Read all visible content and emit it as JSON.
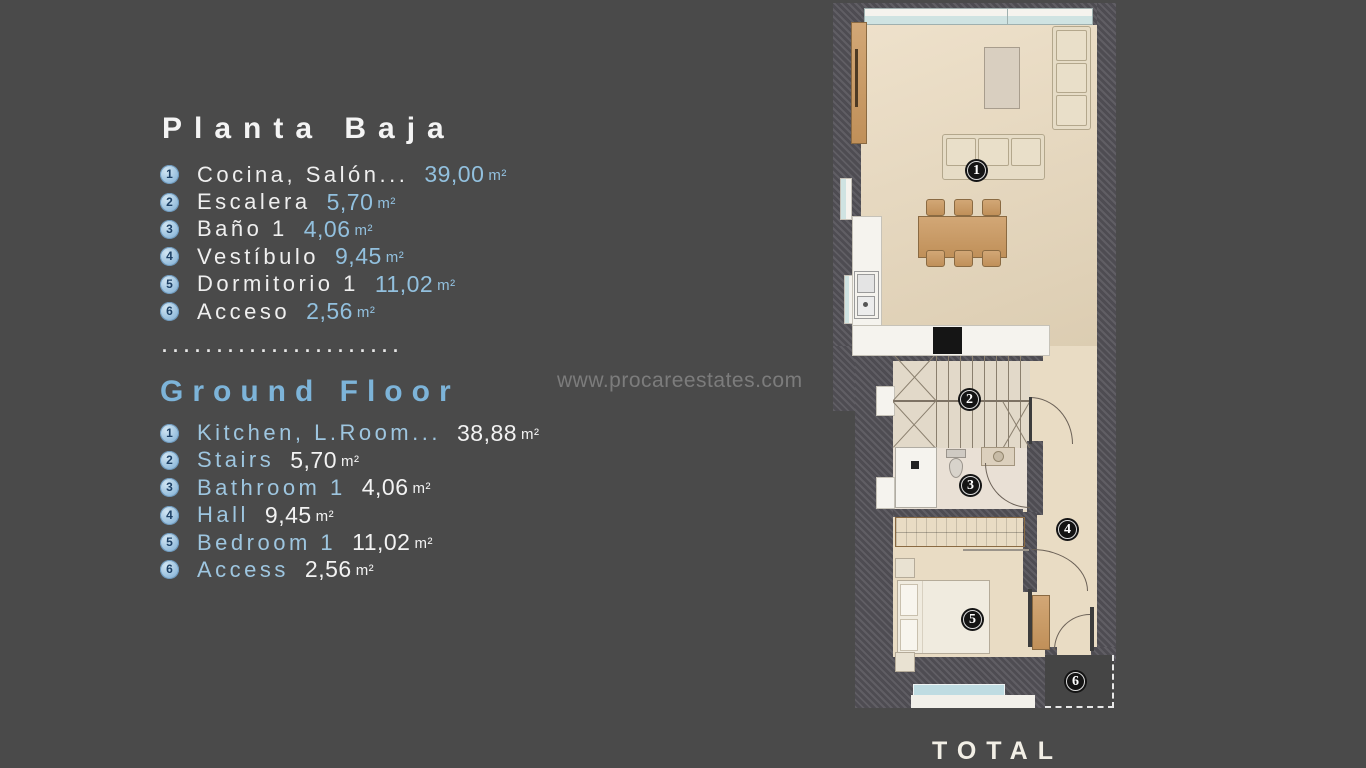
{
  "planta_baja": {
    "title": "Planta Baja",
    "items": [
      {
        "num": "1",
        "label": "Cocina, Salón...",
        "value": "39,00",
        "unit": "m²"
      },
      {
        "num": "2",
        "label": "Escalera",
        "value": "5,70",
        "unit": "m²"
      },
      {
        "num": "3",
        "label": "Baño 1",
        "value": "4,06",
        "unit": "m²"
      },
      {
        "num": "4",
        "label": "Vestíbulo",
        "value": "9,45",
        "unit": "m²"
      },
      {
        "num": "5",
        "label": "Dormitorio 1",
        "value": "11,02",
        "unit": "m²"
      },
      {
        "num": "6",
        "label": "Acceso",
        "value": "2,56",
        "unit": "m²"
      }
    ]
  },
  "separator": {
    "dots": "......................"
  },
  "ground_floor": {
    "title": "Ground Floor",
    "items": [
      {
        "num": "1",
        "label": "Kitchen, L.Room...",
        "value": "38,88",
        "unit": "m²"
      },
      {
        "num": "2",
        "label": "Stairs",
        "value": "5,70",
        "unit": "m²"
      },
      {
        "num": "3",
        "label": "Bathroom 1",
        "value": "4,06",
        "unit": "m²"
      },
      {
        "num": "4",
        "label": "Hall",
        "value": "9,45",
        "unit": "m²"
      },
      {
        "num": "5",
        "label": "Bedroom 1",
        "value": "11,02",
        "unit": "m²"
      },
      {
        "num": "6",
        "label": "Access",
        "value": "2,56",
        "unit": "m²"
      }
    ]
  },
  "watermark": {
    "text": "www.procareestates.com"
  },
  "total": {
    "label": "TOTAL"
  },
  "floorplan": {
    "markers": {
      "living": "1",
      "stairs": "2",
      "bathroom": "3",
      "hall": "4",
      "bedroom": "5",
      "access": "6"
    }
  },
  "colors": {
    "background": "#4a4a4a",
    "wall": "#57555b",
    "floor": "#e8dcc5",
    "accent_blue": "#92c0de",
    "title_blue": "#7db4d9",
    "badge_blue": "#96bedd"
  }
}
